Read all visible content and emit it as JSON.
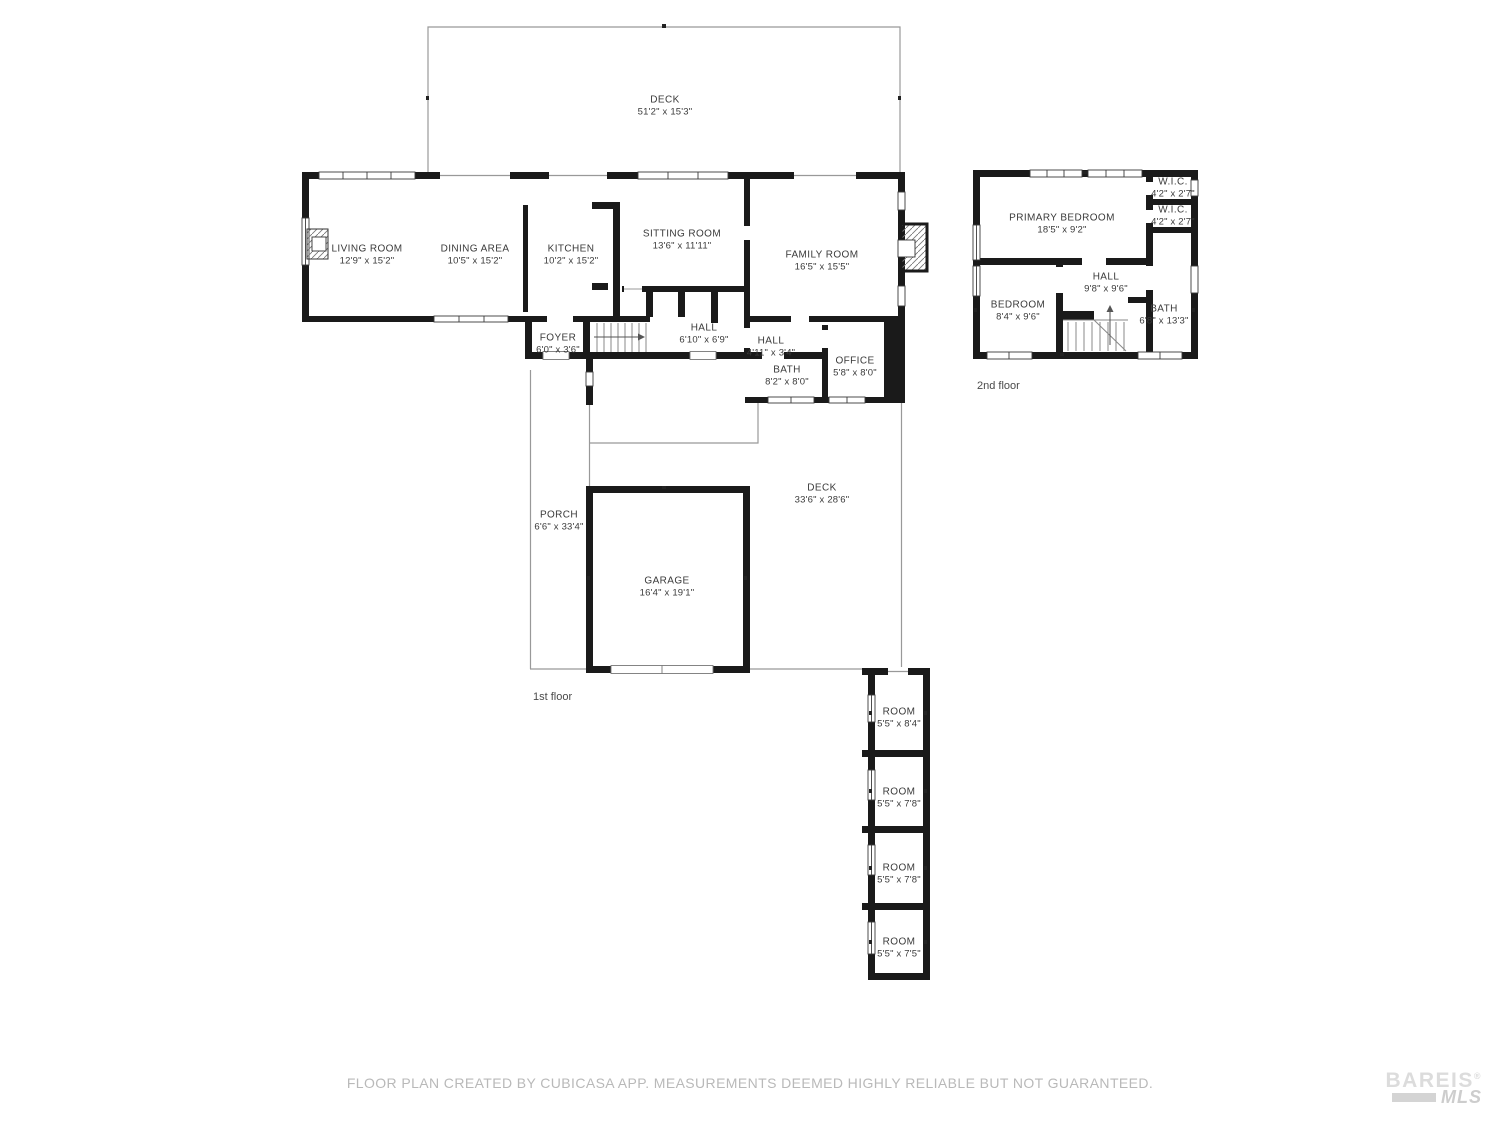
{
  "first_floor": {
    "label": "1st floor",
    "rooms": [
      {
        "name": "DECK",
        "dims": "51'2\" x 15'3\""
      },
      {
        "name": "LIVING ROOM",
        "dims": "12'9\" x 15'2\""
      },
      {
        "name": "DINING AREA",
        "dims": "10'5\" x 15'2\""
      },
      {
        "name": "KITCHEN",
        "dims": "10'2\" x 15'2\""
      },
      {
        "name": "SITTING ROOM",
        "dims": "13'6\" x 11'11\""
      },
      {
        "name": "FAMILY ROOM",
        "dims": "16'5\" x 15'5\""
      },
      {
        "name": "FOYER",
        "dims": "6'0\" x 3'6\""
      },
      {
        "name": "HALL",
        "dims": "6'10\" x 6'9\""
      },
      {
        "name": "HALL",
        "dims": "4'11\" x 3'4\""
      },
      {
        "name": "BATH",
        "dims": "8'2\" x 8'0\""
      },
      {
        "name": "OFFICE",
        "dims": "5'8\" x 8'0\""
      },
      {
        "name": "PORCH",
        "dims": "6'6\" x 33'4\""
      },
      {
        "name": "GARAGE",
        "dims": "16'4\" x 19'1\""
      },
      {
        "name": "DECK",
        "dims": "33'6\" x 28'6\""
      },
      {
        "name": "ROOM",
        "dims": "5'5\" x 8'4\""
      },
      {
        "name": "ROOM",
        "dims": "5'5\" x 7'8\""
      },
      {
        "name": "ROOM",
        "dims": "5'5\" x 7'8\""
      },
      {
        "name": "ROOM",
        "dims": "5'5\" x 7'5\""
      }
    ]
  },
  "second_floor": {
    "label": "2nd floor",
    "rooms": [
      {
        "name": "PRIMARY BEDROOM",
        "dims": "18'5\" x 9'2\""
      },
      {
        "name": "W.I.C.",
        "dims": "4'2\" x 2'7\""
      },
      {
        "name": "W.I.C.",
        "dims": "4'2\" x 2'7\""
      },
      {
        "name": "HALL",
        "dims": "9'8\" x 9'6\""
      },
      {
        "name": "BEDROOM",
        "dims": "8'4\" x 9'6\""
      },
      {
        "name": "BATH",
        "dims": "6'8\" x 13'3\""
      }
    ]
  },
  "footer": {
    "disclaimer": "FLOOR PLAN CREATED BY CUBICASA APP. MEASUREMENTS DEEMED HIGHLY RELIABLE BUT NOT GUARANTEED."
  },
  "logo": {
    "name": "BAREIS",
    "reg": "®",
    "sub": "MLS"
  },
  "colors": {
    "wall": "#1a1a1a",
    "thin_line": "#999999",
    "label_text": "#3a3a3a",
    "footer_text": "#b9b9b9",
    "logo_text": "#dcdcdc"
  }
}
